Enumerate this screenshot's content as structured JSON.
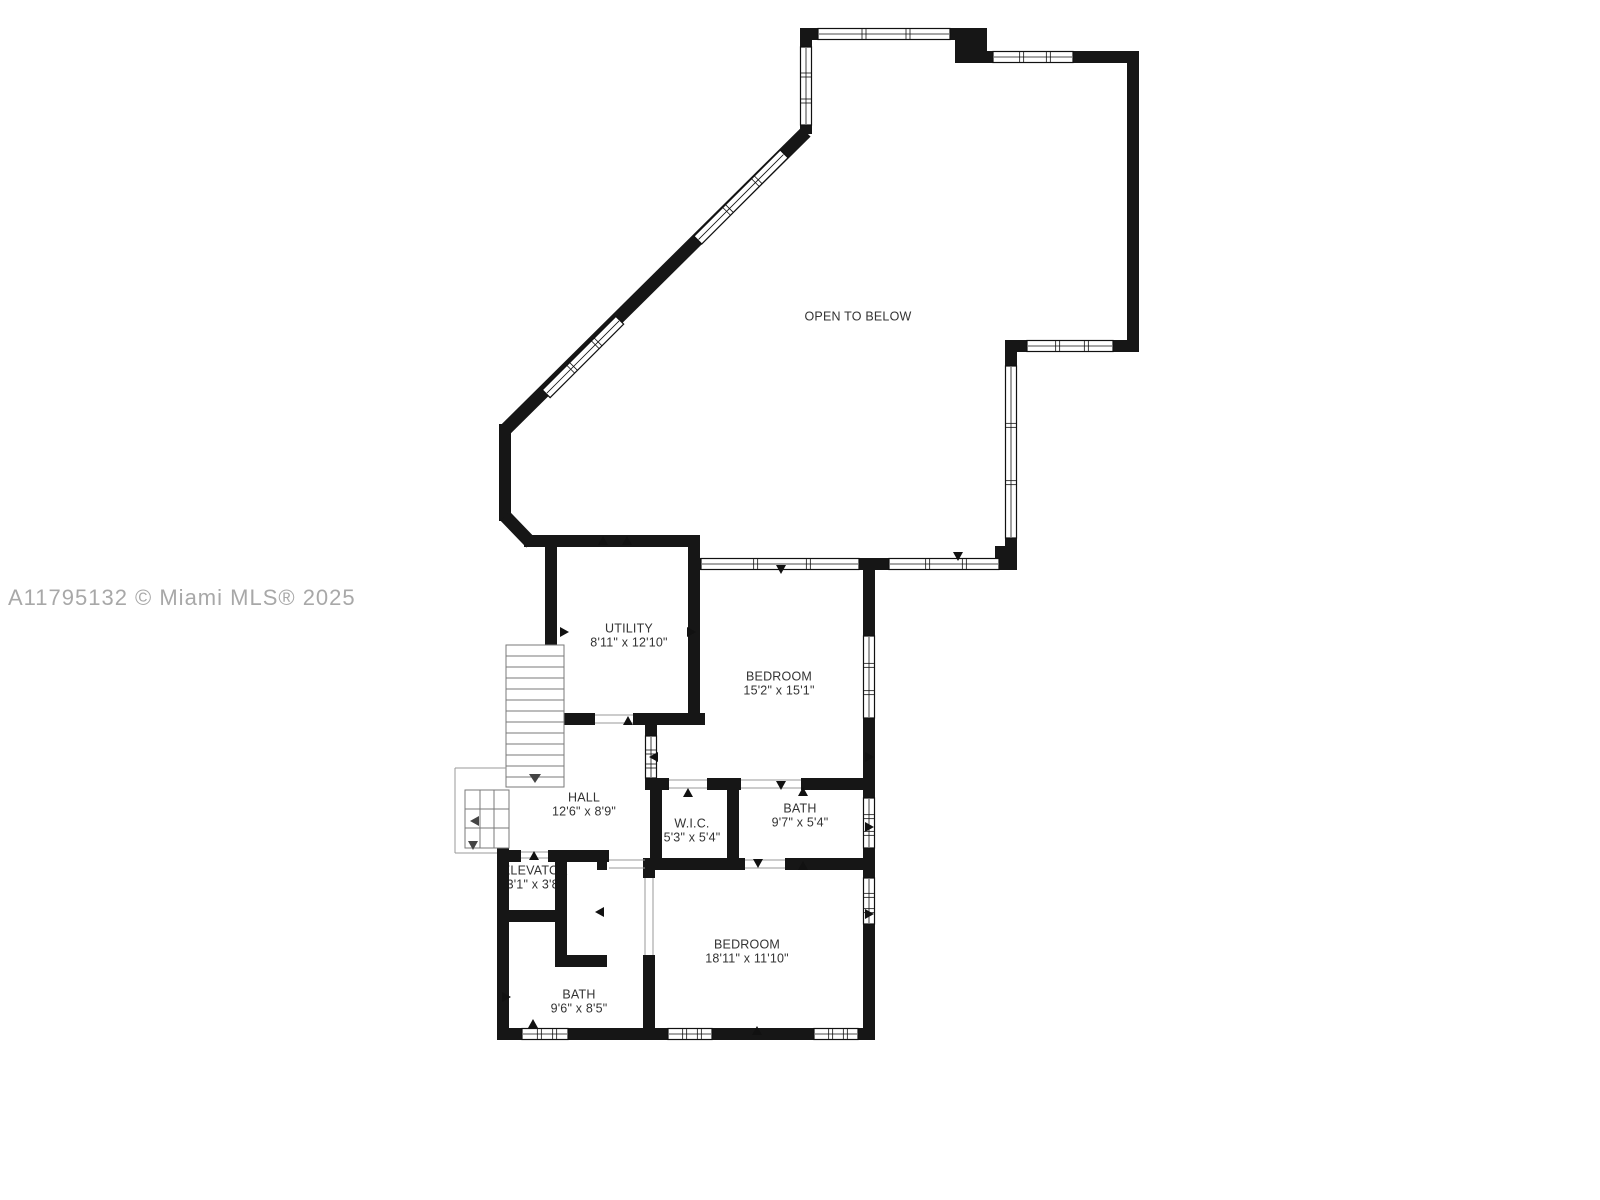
{
  "watermark": {
    "text": "A11795132 © Miami MLS® 2025"
  },
  "rooms": [
    {
      "id": "open-to-below",
      "name": "OPEN TO BELOW",
      "dims": ""
    },
    {
      "id": "utility",
      "name": "UTILITY",
      "dims": "8'11\" x 12'10\""
    },
    {
      "id": "bedroom-1",
      "name": "BEDROOM",
      "dims": "15'2\" x 15'1\""
    },
    {
      "id": "hall",
      "name": "HALL",
      "dims": "12'6\" x 8'9\""
    },
    {
      "id": "wic",
      "name": "W.I.C.",
      "dims": "5'3\" x 5'4\""
    },
    {
      "id": "bath-1",
      "name": "BATH",
      "dims": "9'7\" x 5'4\""
    },
    {
      "id": "elevator",
      "name": "ELEVATOR",
      "dims": "3'1\" x 3'8\""
    },
    {
      "id": "bedroom-2",
      "name": "BEDROOM",
      "dims": "18'11\" x 11'10\""
    },
    {
      "id": "bath-2",
      "name": "BATH",
      "dims": "9'6\" x 8'5\""
    }
  ],
  "colors": {
    "background": "#ffffff",
    "wall": "#161616",
    "room_label": "#333333",
    "watermark": "#a8a8a8",
    "thin_detail": "#7a7a7a"
  }
}
